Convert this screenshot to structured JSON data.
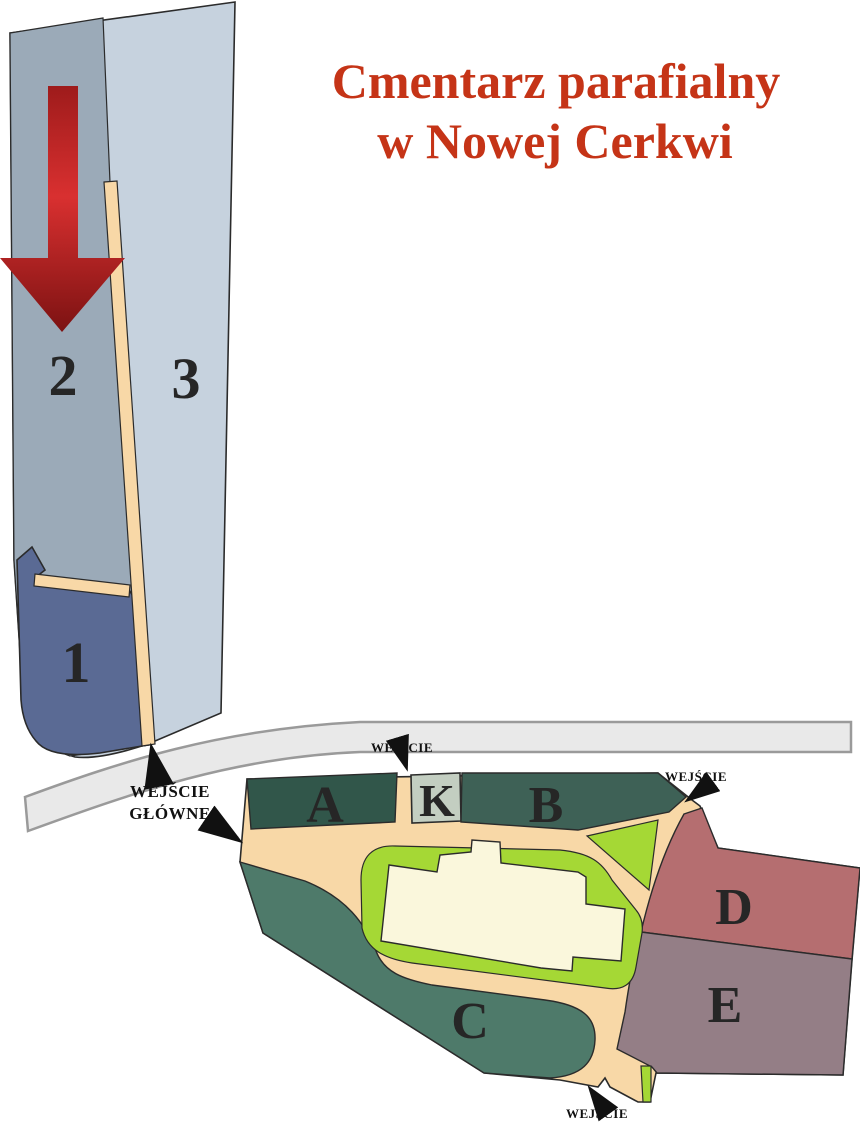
{
  "title": {
    "line1": "Cmentarz parafialny",
    "line2": "w Nowej Cerkwi"
  },
  "map": {
    "upper_sections": {
      "s1": "1",
      "s2": "2",
      "s3": "3"
    },
    "lower_sections": {
      "a": "A",
      "b": "B",
      "c": "C",
      "d": "D",
      "e": "E",
      "k": "K"
    },
    "entrances": {
      "main_line1": "WEJŚCIE",
      "main_line2": "GŁÓWNE",
      "top": "WEJŚCIE",
      "right": "WEJŚCIE",
      "bottom": "WEJŚCIE"
    }
  },
  "colors": {
    "title_text": "#C53417",
    "section_1": "#5A6A94",
    "section_2": "#9BAAB8",
    "section_3": "#C6D2DE",
    "section_a": "#31564A",
    "section_b": "#3E6156",
    "section_c": "#4E7A6A",
    "section_d": "#B56E70",
    "section_e": "#947E86",
    "section_k": "#C3CEC1",
    "path_tan": "#F8D8A7",
    "lawn_green": "#A5D835",
    "building_cream": "#FAF7DC",
    "road_fill": "#E9E9E9",
    "road_stroke": "#9A9A9A",
    "outline": "#2B2B2B",
    "label_text": "#262626",
    "arrow_red_top": "#9E1B1B",
    "arrow_red_mid": "#D93030",
    "arrow_red_bottom": "#7C1212",
    "black_arrow": "#111111"
  }
}
